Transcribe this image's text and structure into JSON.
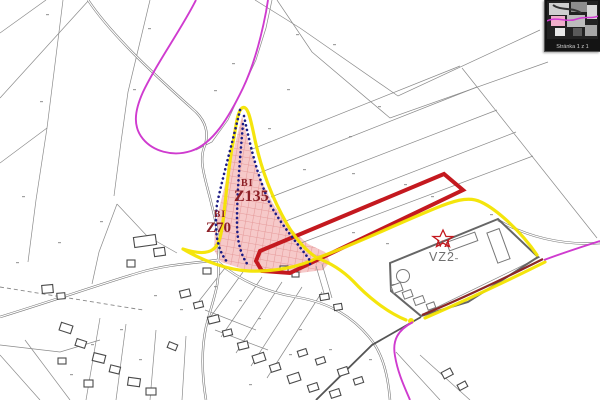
{
  "pager": {
    "page_status": "Stránka 1 z 1"
  },
  "zones": {
    "bi_z135": {
      "type_label": "BI",
      "code": "Z135"
    },
    "bi_z70": {
      "type_label": "BI",
      "code": "Z70"
    },
    "vz_vz2": {
      "type_label": "VZ",
      "code": "VZ2"
    }
  },
  "colors": {
    "developable_boundary_yellow": "#f4e400",
    "highlight_plot_red": "#c4191f",
    "territory_boundary_magenta": "#cf3bcf",
    "builtup_boundary_dark_red": "#8b2828",
    "reserve_boundary_blue_dotted": "#1b1b85",
    "bi_zone_fill_pink": "#f6c9c9",
    "bi_zone_hatch": "#e59a9a",
    "bi_label_dark_red": "#8c1f26",
    "vz_label_red": "#c4191f",
    "vz2_label_gray": "#6f6f6f",
    "parcel_line_gray": "#8a8a8a"
  }
}
